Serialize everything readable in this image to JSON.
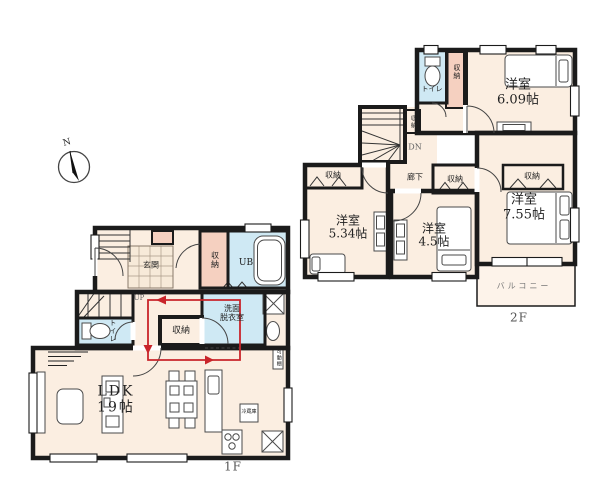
{
  "compass": {
    "north": "N"
  },
  "colors": {
    "wall": "#1b1b1b",
    "room_fill": "#fbeee1",
    "closet_fill": "#f5d0c0",
    "wet_area_fill": "#cfe9f4",
    "flow_line": "#c9252b"
  },
  "floor1": {
    "floor_label": "1F",
    "ldk": {
      "name": "LDK",
      "size": "19帖"
    },
    "genkan": "玄関",
    "entrance_storage": "収納",
    "unit_bath": "UB",
    "toilet": "トイレ",
    "hall_storage": "収納",
    "washroom_line1": "洗面",
    "washroom_line2": "脱衣室",
    "stairs_up": "UP",
    "fridge": "冷蔵庫",
    "shelf": "可動棚"
  },
  "floor2": {
    "floor_label": "2F",
    "toilet": "トイレ",
    "toilet_storage": "収納",
    "bedroom_ne": {
      "name": "洋室",
      "size": "6.09帖"
    },
    "stairs_storage": "収納",
    "stairs_down": "DN",
    "hallway": "廊下",
    "bedroom_w_storage": "収納",
    "bedroom_w": {
      "name": "洋室",
      "size": "5.34帖"
    },
    "bedroom_c_storage": "収納",
    "bedroom_c": {
      "name": "洋室",
      "size": "4.5帖"
    },
    "bedroom_se_storage": "収納",
    "bedroom_se": {
      "name": "洋室",
      "size": "7.55帖"
    },
    "balcony": "バルコニー"
  }
}
